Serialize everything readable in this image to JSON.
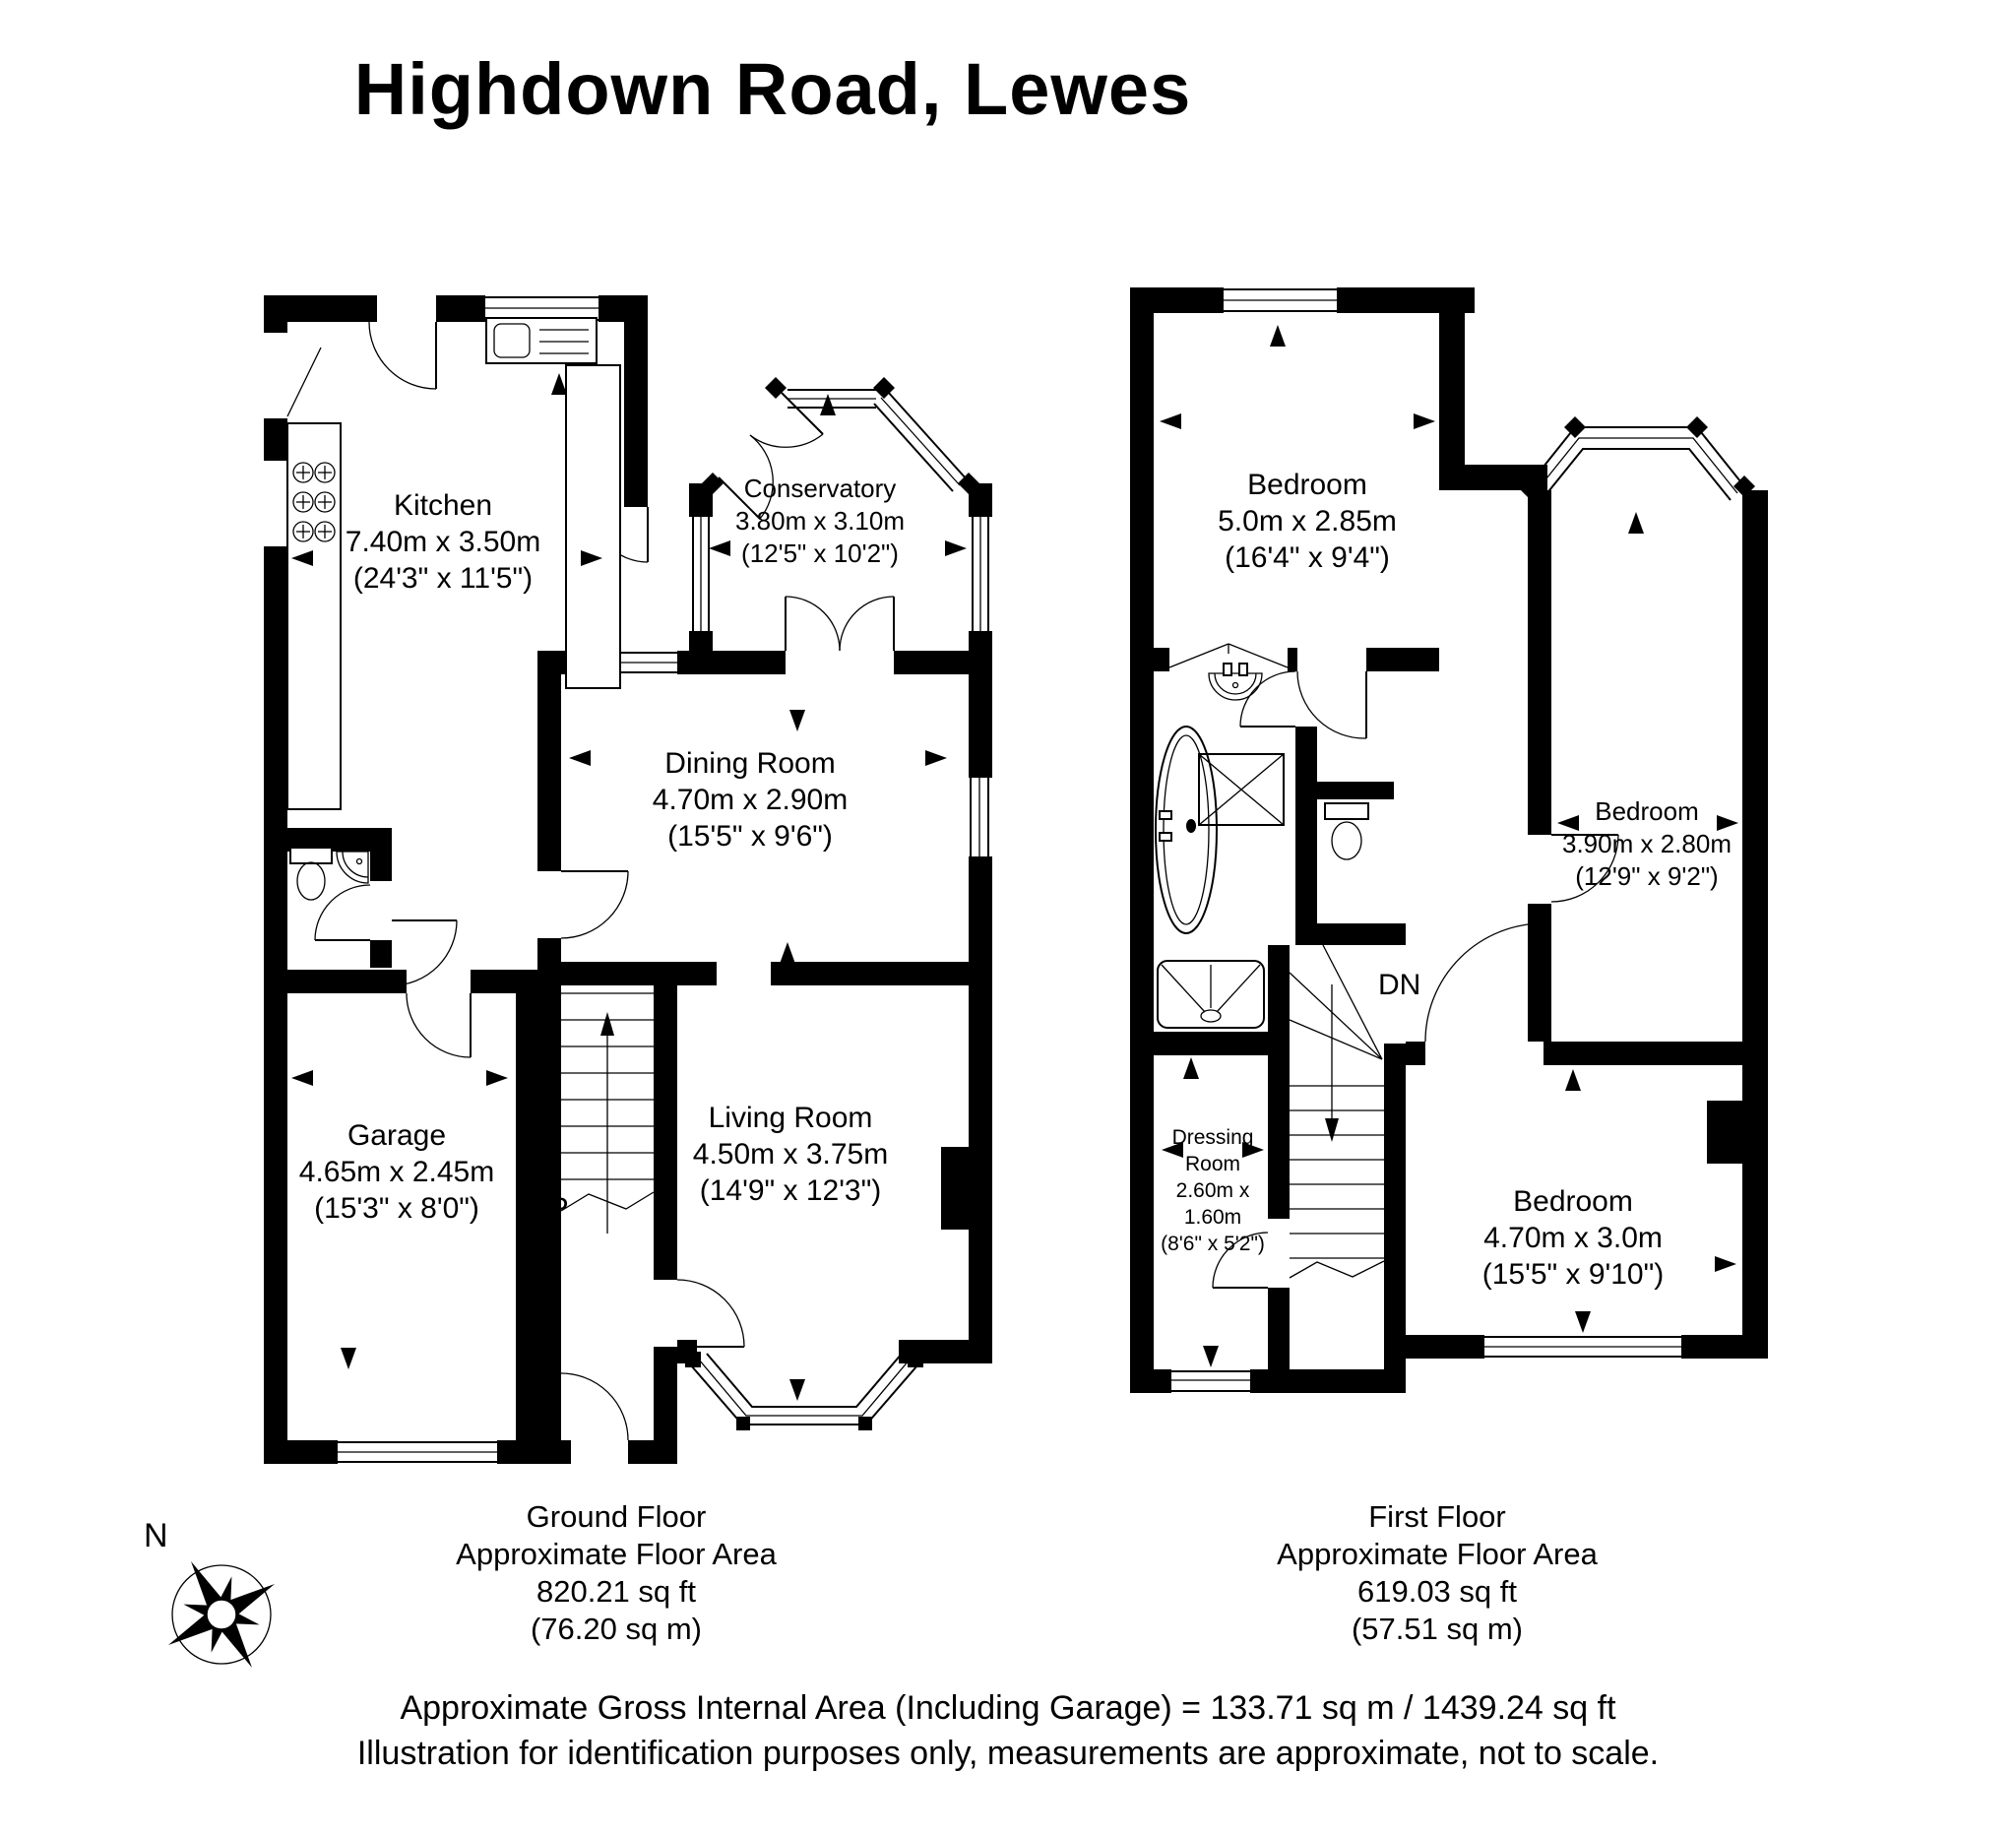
{
  "title": "Highdown Road, Lewes",
  "ground_floor": {
    "rooms": [
      {
        "name": "Kitchen",
        "metric": "7.40m x 3.50m",
        "imperial": "(24'3\" x 11'5\")"
      },
      {
        "name": "Conservatory",
        "metric": "3.80m x 3.10m",
        "imperial": "(12'5\" x 10'2\")"
      },
      {
        "name": "Dining Room",
        "metric": "4.70m x 2.90m",
        "imperial": "(15'5\" x 9'6\")"
      },
      {
        "name": "Living Room",
        "metric": "4.50m x 3.75m",
        "imperial": "(14'9\" x 12'3\")"
      },
      {
        "name": "Garage",
        "metric": "4.65m x 2.45m",
        "imperial": "(15'3\" x 8'0\")"
      }
    ],
    "stairs_label": "UP",
    "caption": {
      "line1": "Ground Floor",
      "line2": "Approximate Floor Area",
      "line3": "820.21 sq ft",
      "line4": "(76.20 sq m)"
    }
  },
  "first_floor": {
    "rooms": [
      {
        "name": "Bedroom",
        "metric": "5.0m x 2.85m",
        "imperial": "(16'4\" x 9'4\")"
      },
      {
        "name": "Bedroom",
        "metric": "3.90m x 2.80m",
        "imperial": "(12'9\" x 9'2\")"
      },
      {
        "name": "Bedroom",
        "metric": "4.70m x 3.0m",
        "imperial": "(15'5\" x 9'10\")"
      },
      {
        "name": "Dressing Room",
        "metric": "2.60m x 1.60m",
        "imperial": "(8'6\" x 5'2\")"
      }
    ],
    "stairs_label": "DN",
    "caption": {
      "line1": "First Floor",
      "line2": "Approximate Floor Area",
      "line3": "619.03 sq ft",
      "line4": "(57.51 sq m)"
    }
  },
  "footer": {
    "line1": "Approximate Gross Internal Area (Including Garage) = 133.71 sq m / 1439.24 sq ft",
    "line2": "Illustration for identification purposes only, measurements are approximate, not to scale."
  },
  "compass": {
    "label": "N"
  },
  "colors": {
    "wall": "#000000",
    "background": "#ffffff"
  }
}
